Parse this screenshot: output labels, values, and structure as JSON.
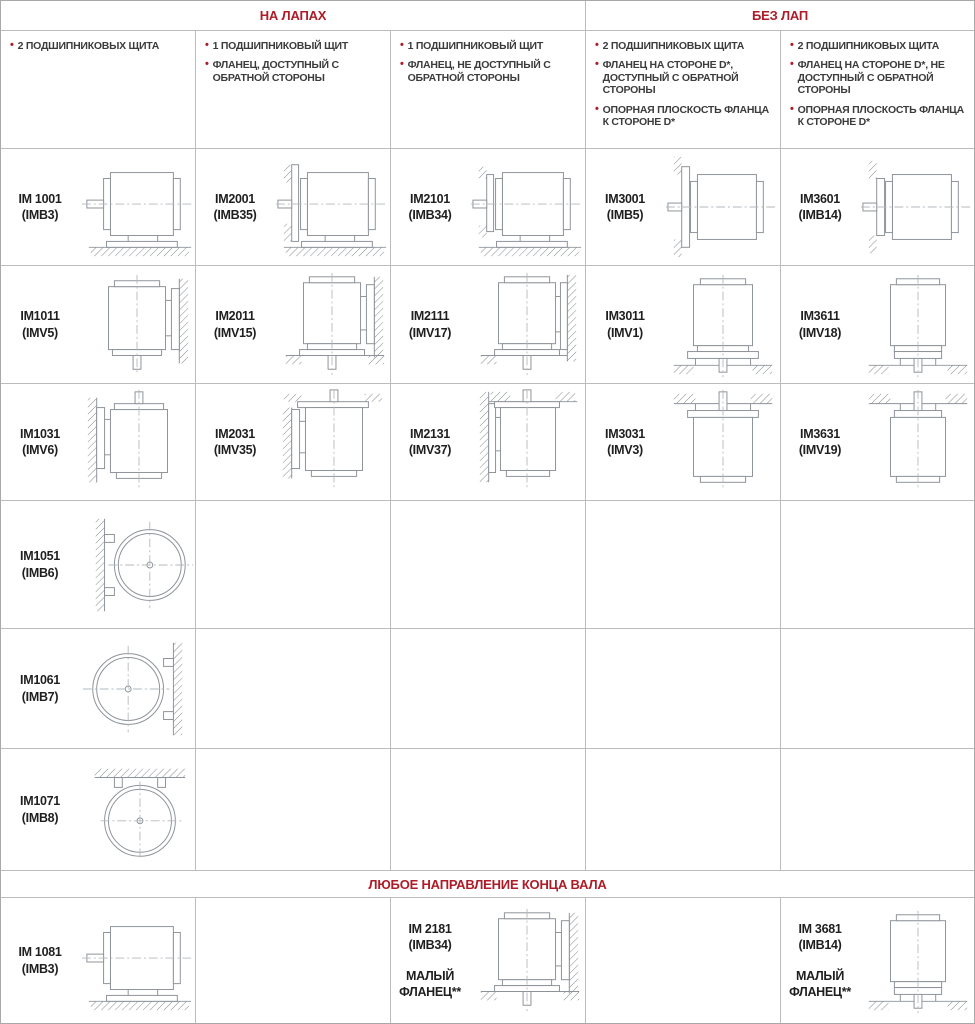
{
  "colors": {
    "accent": "#ae1c28",
    "grid": "#bcbcbc",
    "bullet_text": "#3c3c3c",
    "label_text": "#1f1f1f",
    "diagram_line": "#8e939a",
    "diagram_hatch": "#84898f",
    "diagram_centerline": "#b3b8bd"
  },
  "headers": {
    "left": "НА ЛАПАХ",
    "right": "БЕЗ ЛАП",
    "bottom": "ЛЮБОЕ НАПРАВЛЕНИЕ КОНЦА ВАЛА"
  },
  "columns": [
    {
      "bullets": [
        "2 ПОДШИПНИКОВЫХ ЩИТА"
      ]
    },
    {
      "bullets": [
        "1 ПОДШИПНИКОВЫЙ ЩИТ",
        "ФЛАНЕЦ,  ДОСТУПНЫЙ С ОБРАТНОЙ СТОРОНЫ"
      ]
    },
    {
      "bullets": [
        "1 ПОДШИПНИКОВЫЙ ЩИТ",
        "ФЛАНЕЦ, НЕ ДОСТУПНЫЙ С ОБРАТНОЙ СТОРОНЫ"
      ]
    },
    {
      "bullets": [
        "2 ПОДШИПНИКОВЫХ ЩИТА",
        "ФЛАНЕЦ НА СТОРОНЕ D*, ДОСТУПНЫЙ С ОБРАТНОЙ СТОРОНЫ",
        "ОПОРНАЯ ПЛОСКОСТЬ ФЛАНЦА К СТОРОНЕ D*"
      ]
    },
    {
      "bullets": [
        "2 ПОДШИПНИКОВЫХ ЩИТА",
        "ФЛАНЕЦ НА СТОРОНЕ D*, НЕ ДОСТУПНЫЙ С ОБРАТНОЙ СТОРОНЫ",
        "ОПОРНАЯ ПЛОСКОСТЬ ФЛАНЦА К СТОРОНЕ D*"
      ]
    }
  ],
  "rows": [
    [
      {
        "id": "IM 1001",
        "sub": "(IMB3)",
        "variant": "sideFeetGround"
      },
      {
        "id": "IM2001",
        "sub": "(IMB35)",
        "variant": "sideFeetFlangeWall"
      },
      {
        "id": "IM2101",
        "sub": "(IMB34)",
        "variant": "sideFeetSmallFlange"
      },
      {
        "id": "IM3001",
        "sub": "(IMB5)",
        "variant": "sideFlangeWall"
      },
      {
        "id": "IM3601",
        "sub": "(IMB14)",
        "variant": "sideSmallFlangeWall"
      }
    ],
    [
      {
        "id": "IM1011",
        "sub": "(IMV5)",
        "variant": "vertDownFeetWall"
      },
      {
        "id": "IM2011",
        "sub": "(IMV15)",
        "variant": "vertDownFeetWallFlangeFloor"
      },
      {
        "id": "IM2111",
        "sub": "(IMV17)",
        "variant": "vertDownWallFlangeFloor"
      },
      {
        "id": "IM3011",
        "sub": "(IMV1)",
        "variant": "vertDownFlangeFloor"
      },
      {
        "id": "IM3611",
        "sub": "(IMV18)",
        "variant": "vertDownSmallFlangeFloor"
      }
    ],
    [
      {
        "id": "IM1031",
        "sub": "(IMV6)",
        "variant": "vertUpFeetWall"
      },
      {
        "id": "IM2031",
        "sub": "(IMV35)",
        "variant": "vertUpFeetWallFlangeCeiling"
      },
      {
        "id": "IM2131",
        "sub": "(IMV37)",
        "variant": "vertUpWallFlangeCeiling"
      },
      {
        "id": "IM3031",
        "sub": "(IMV3)",
        "variant": "vertUpFlangeCeiling"
      },
      {
        "id": "IM3631",
        "sub": "(IMV19)",
        "variant": "vertUpSmallFlangeCeiling"
      }
    ],
    [
      {
        "id": "IM1051",
        "sub": "(IMB6)",
        "variant": "frontWallLeft"
      },
      null,
      null,
      null,
      null
    ],
    [
      {
        "id": "IM1061",
        "sub": "(IMB7)",
        "variant": "frontWallRight"
      },
      null,
      null,
      null,
      null
    ],
    [
      {
        "id": "IM1071",
        "sub": "(IMB8)",
        "variant": "frontCeiling"
      },
      null,
      null,
      null,
      null
    ]
  ],
  "bottom_row": [
    {
      "id": "IM 1081",
      "sub": "(IMB3)",
      "variant": "sideFeetGround"
    },
    null,
    {
      "id": "IM 2181",
      "sub": "(IMB34)",
      "note": "МАЛЫЙ ФЛАНЕЦ**",
      "variant": "vertDownFeetWallFlangeFloor"
    },
    null,
    {
      "id": "IM 3681",
      "sub": "(IMB14)",
      "note": "МАЛЫЙ ФЛАНЕЦ**",
      "variant": "vertDownSmallFlangeFloor"
    }
  ]
}
